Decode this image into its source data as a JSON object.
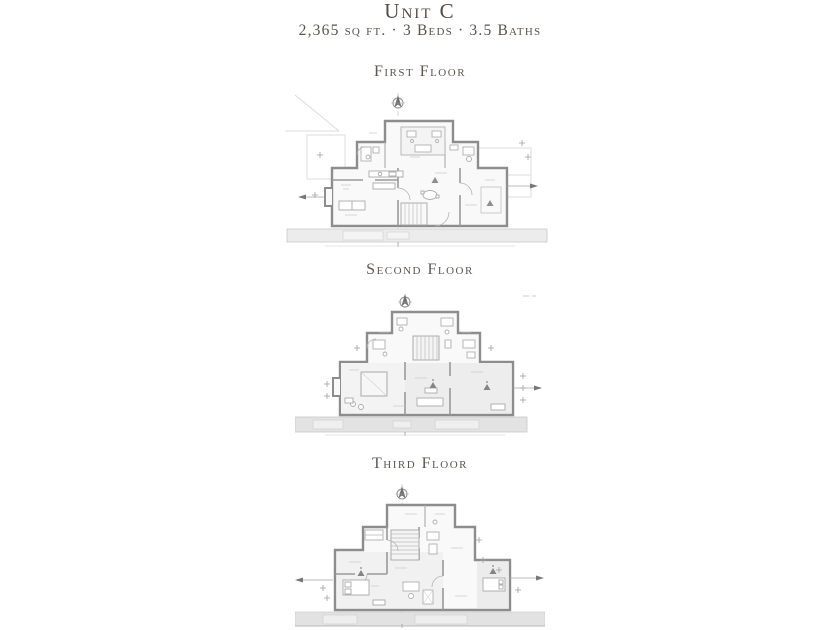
{
  "header": {
    "title": "Unit C",
    "specs": "2,365 sq ft. · 3 Beds · 3.5 Baths"
  },
  "floors": [
    {
      "id": "first",
      "label": "First Floor"
    },
    {
      "id": "second",
      "label": "Second Floor"
    },
    {
      "id": "third",
      "label": "Third Floor"
    }
  ],
  "icons": {
    "north_arrow": "north-arrow",
    "ceiling_fan": "ceiling-fan"
  },
  "colors": {
    "page_background": "#ffffff",
    "title_text": "#544d45",
    "specs_text": "#5a544c",
    "floor_title_text": "#5d574f",
    "plan_wall": "#8d8d8d",
    "plan_partition": "#9a9a9a",
    "plan_thin_line": "#b5b5b5",
    "plan_faint_line": "#d8d8d8",
    "room_fill": "#f9f9f9",
    "room_tint": "#ededed",
    "terrace_fill": "#e4e4e4"
  }
}
